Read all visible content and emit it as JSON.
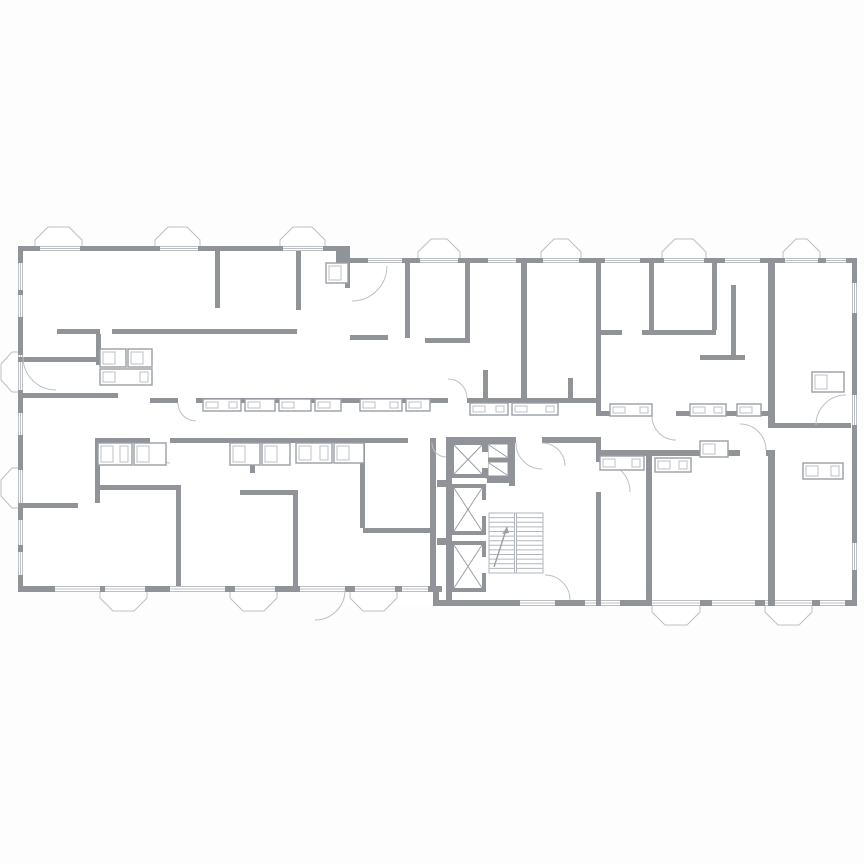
{
  "canvas": {
    "width": 864,
    "height": 864,
    "background": "#fdfdfd"
  },
  "colors": {
    "wall": "#909499",
    "light_line": "#bcc0c5",
    "fixture_stroke": "#9aa0a5",
    "stair_line": "#b2b7bd",
    "room_fill": "#ffffff"
  },
  "plan": {
    "window_bands": [
      {
        "x": 18,
        "y": 246,
        "w": 328,
        "h": 5
      },
      {
        "x": 346,
        "y": 258,
        "w": 511,
        "h": 5
      },
      {
        "x": 18,
        "y": 251,
        "w": 5,
        "h": 341
      },
      {
        "x": 852,
        "y": 263,
        "w": 5,
        "h": 343
      },
      {
        "x": 18,
        "y": 586,
        "w": 424,
        "h": 6
      },
      {
        "x": 438,
        "y": 600,
        "w": 419,
        "h": 6
      }
    ],
    "exterior_walls": [
      [
        18,
        246,
        22,
        5
      ],
      [
        80,
        246,
        80,
        5
      ],
      [
        198,
        246,
        85,
        5
      ],
      [
        323,
        246,
        23,
        5
      ],
      [
        346,
        258,
        22,
        5
      ],
      [
        402,
        258,
        18,
        5
      ],
      [
        458,
        258,
        30,
        5
      ],
      [
        516,
        258,
        27,
        5
      ],
      [
        579,
        258,
        26,
        5
      ],
      [
        640,
        258,
        24,
        5
      ],
      [
        704,
        258,
        21,
        5
      ],
      [
        760,
        258,
        25,
        5
      ],
      [
        818,
        258,
        8,
        5
      ],
      [
        846,
        258,
        11,
        5
      ],
      [
        18,
        246,
        5,
        17
      ],
      [
        18,
        290,
        5,
        5
      ],
      [
        18,
        317,
        5,
        38
      ],
      [
        18,
        390,
        5,
        23
      ],
      [
        18,
        435,
        5,
        35
      ],
      [
        18,
        506,
        5,
        14
      ],
      [
        18,
        545,
        5,
        7
      ],
      [
        18,
        575,
        5,
        17
      ],
      [
        852,
        258,
        5,
        25
      ],
      [
        852,
        313,
        5,
        82
      ],
      [
        852,
        425,
        5,
        118
      ],
      [
        852,
        570,
        5,
        36
      ],
      [
        18,
        586,
        37,
        6
      ],
      [
        100,
        586,
        5,
        6
      ],
      [
        145,
        586,
        25,
        6
      ],
      [
        225,
        586,
        10,
        6
      ],
      [
        275,
        586,
        25,
        6
      ],
      [
        345,
        586,
        10,
        6
      ],
      [
        395,
        586,
        7,
        6
      ],
      [
        428,
        586,
        14,
        6
      ],
      [
        438,
        600,
        82,
        6
      ],
      [
        555,
        600,
        30,
        6
      ],
      [
        620,
        600,
        32,
        6
      ],
      [
        700,
        600,
        12,
        6
      ],
      [
        755,
        600,
        10,
        6
      ],
      [
        812,
        600,
        8,
        6
      ],
      [
        845,
        600,
        12,
        6
      ]
    ],
    "interior_walls": [
      [
        336,
        246,
        14,
        22
      ],
      [
        433,
        586,
        6,
        20
      ],
      [
        215,
        251,
        5,
        57
      ],
      [
        296,
        251,
        5,
        59
      ],
      [
        57,
        329,
        43,
        5
      ],
      [
        112,
        329,
        185,
        5
      ],
      [
        96,
        334,
        5,
        31
      ],
      [
        18,
        357,
        80,
        5
      ],
      [
        18,
        393,
        100,
        5
      ],
      [
        95,
        438,
        5,
        65
      ],
      [
        150,
        398,
        28,
        5
      ],
      [
        196,
        398,
        252,
        5
      ],
      [
        467,
        398,
        129,
        5
      ],
      [
        596,
        398,
        5,
        18
      ],
      [
        600,
        411,
        52,
        5
      ],
      [
        676,
        411,
        92,
        5
      ],
      [
        97,
        438,
        53,
        5
      ],
      [
        170,
        438,
        238,
        5
      ],
      [
        430,
        438,
        6,
        148
      ],
      [
        446,
        437,
        6,
        163
      ],
      [
        446,
        437,
        70,
        6
      ],
      [
        542,
        437,
        54,
        6
      ],
      [
        596,
        437,
        5,
        19
      ],
      [
        596,
        456,
        5,
        6
      ],
      [
        596,
        492,
        5,
        114
      ],
      [
        600,
        450,
        140,
        6
      ],
      [
        766,
        450,
        9,
        6
      ],
      [
        521,
        263,
        6,
        135
      ],
      [
        596,
        263,
        5,
        135
      ],
      [
        405,
        263,
        5,
        75
      ],
      [
        465,
        263,
        5,
        75
      ],
      [
        425,
        338,
        45,
        5
      ],
      [
        350,
        335,
        38,
        5
      ],
      [
        345,
        258,
        5,
        30
      ],
      [
        649,
        263,
        5,
        67
      ],
      [
        712,
        263,
        5,
        67
      ],
      [
        596,
        330,
        26,
        5
      ],
      [
        642,
        330,
        74,
        5
      ],
      [
        768,
        263,
        7,
        160
      ],
      [
        700,
        355,
        45,
        5
      ],
      [
        731,
        285,
        5,
        72
      ],
      [
        768,
        423,
        83,
        5
      ],
      [
        768,
        453,
        7,
        153
      ],
      [
        646,
        453,
        6,
        153
      ],
      [
        176,
        485,
        5,
        101
      ],
      [
        95,
        485,
        81,
        5
      ],
      [
        18,
        503,
        60,
        5
      ],
      [
        293,
        490,
        5,
        96
      ],
      [
        240,
        490,
        53,
        5
      ],
      [
        360,
        438,
        5,
        90
      ],
      [
        363,
        528,
        67,
        5
      ],
      [
        250,
        438,
        5,
        35
      ],
      [
        437,
        480,
        15,
        7
      ],
      [
        437,
        538,
        15,
        7
      ],
      [
        509,
        437,
        6,
        49
      ],
      [
        487,
        477,
        28,
        6
      ],
      [
        483,
        370,
        5,
        28
      ],
      [
        568,
        378,
        5,
        25
      ]
    ],
    "top_bays": [
      {
        "x1": 35,
        "x2": 82,
        "y": 246
      },
      {
        "x1": 155,
        "x2": 200,
        "y": 246
      },
      {
        "x1": 280,
        "x2": 325,
        "y": 246
      },
      {
        "x1": 418,
        "x2": 460,
        "y": 258
      },
      {
        "x1": 541,
        "x2": 581,
        "y": 258
      },
      {
        "x1": 662,
        "x2": 706,
        "y": 258
      },
      {
        "x1": 783,
        "x2": 820,
        "y": 258
      }
    ],
    "bottom_bays": [
      {
        "x1": 100,
        "x2": 147,
        "y": 592
      },
      {
        "x1": 230,
        "x2": 277,
        "y": 592
      },
      {
        "x1": 350,
        "x2": 397,
        "y": 592
      },
      {
        "x1": 652,
        "x2": 700,
        "y": 606
      },
      {
        "x1": 765,
        "x2": 812,
        "y": 606
      }
    ],
    "left_bays": [
      {
        "y1": 352,
        "y2": 392,
        "x": 18
      },
      {
        "y1": 468,
        "y2": 508,
        "x": 18
      }
    ],
    "elevator_shafts": [
      {
        "x": 452,
        "y": 443,
        "w": 32,
        "h": 33
      },
      {
        "x": 452,
        "y": 486,
        "w": 32,
        "h": 47
      },
      {
        "x": 452,
        "y": 543,
        "w": 32,
        "h": 47
      }
    ],
    "small_shafts": [
      {
        "x": 487,
        "y": 443,
        "w": 22,
        "h": 16
      },
      {
        "x": 487,
        "y": 461,
        "w": 22,
        "h": 16
      }
    ],
    "elevator_door_notches": [
      [
        482,
        452,
        6,
        16
      ],
      [
        482,
        500,
        6,
        16
      ],
      [
        482,
        557,
        6,
        16
      ]
    ],
    "stairs": {
      "x": 489,
      "y": 513,
      "w": 54,
      "h": 60,
      "flight_split": 515.5,
      "treads": 13,
      "arrow": {
        "x1": 494,
        "y1": 567,
        "x2": 507,
        "y2": 527
      }
    },
    "door_arcs": [
      "M178,403 A18,18 0 0 0 196,421",
      "M150,443 A20,20 0 0 0 170,463",
      "M467,398 A19,19 0 0 0 448,379",
      "M516,443 A26,26 0 0 0 542,469",
      "M565,466 A23,23 0 0 0 542,443",
      "M600,462 A30,30 0 0 1 630,492",
      "M652,416 A24,24 0 0 0 676,440",
      "M766,450 A26,26 0 0 0 740,424",
      "M345,590 A30,30 0 0 1 315,620",
      "M387,266 A35,35 0 0 1 352,301",
      "M432,443 A14,14 0 0 0 446,457",
      "M23,357 A33,33 0 0 0 56,390",
      "M846,395 A30,30 0 0 0 816,425",
      "M545,575 A25,25 0 0 1 570,600"
    ],
    "fixtures": [
      [
        203,
        399,
        38,
        12
      ],
      [
        245,
        399,
        30,
        12
      ],
      [
        279,
        399,
        32,
        12
      ],
      [
        315,
        399,
        26,
        12
      ],
      [
        360,
        399,
        42,
        12
      ],
      [
        406,
        399,
        24,
        12
      ],
      [
        470,
        403,
        38,
        12
      ],
      [
        512,
        403,
        46,
        12
      ],
      [
        610,
        404,
        42,
        12
      ],
      [
        690,
        404,
        36,
        12
      ],
      [
        737,
        404,
        24,
        12
      ],
      [
        100,
        349,
        26,
        18
      ],
      [
        128,
        349,
        24,
        18
      ],
      [
        100,
        369,
        52,
        16
      ],
      [
        326,
        263,
        22,
        20
      ],
      [
        812,
        372,
        32,
        20
      ],
      [
        98,
        443,
        34,
        22
      ],
      [
        134,
        443,
        32,
        22
      ],
      [
        230,
        443,
        30,
        22
      ],
      [
        262,
        443,
        28,
        22
      ],
      [
        296,
        443,
        36,
        20
      ],
      [
        334,
        443,
        30,
        20
      ],
      [
        600,
        456,
        44,
        14
      ],
      [
        655,
        458,
        36,
        14
      ],
      [
        700,
        441,
        28,
        16
      ],
      [
        803,
        463,
        40,
        16
      ]
    ]
  }
}
